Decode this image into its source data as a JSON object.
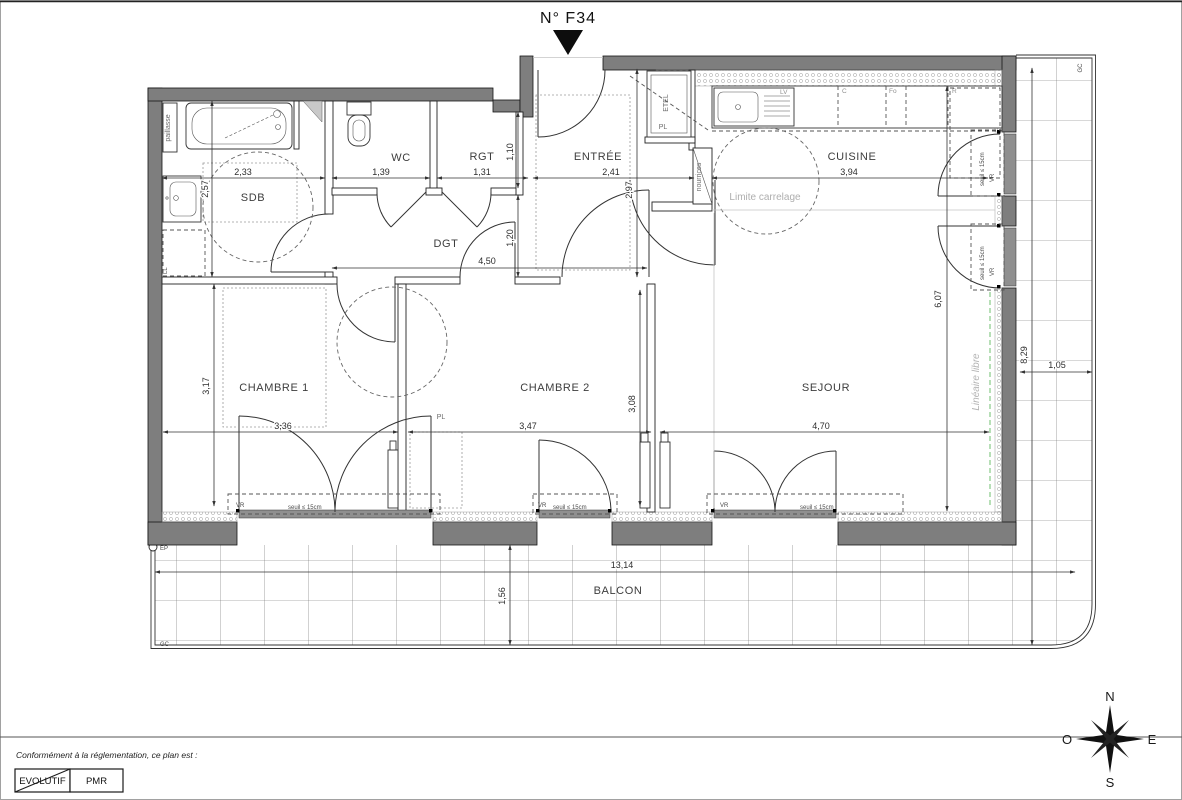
{
  "title": {
    "label": "N° F34"
  },
  "rooms": {
    "sdb": "SDB",
    "wc": "WC",
    "rgt": "RGT",
    "entree": "ENTRÉE",
    "cuisine": "CUISINE",
    "dgt": "DGT",
    "chambre1": "CHAMBRE 1",
    "chambre2": "CHAMBRE 2",
    "sejour": "SEJOUR",
    "balcon": "BALCON"
  },
  "dims": {
    "sdb_w": "2,33",
    "sdb_h": "2,57",
    "wc_w": "1,39",
    "rgt_w": "1,31",
    "rgt_h": "1,10",
    "entree_w": "2,41",
    "entree_h": "2,97",
    "cuisine_w": "3,94",
    "dgt_w": "4,50",
    "dgt_h": "1,20",
    "ch1_w": "3,36",
    "ch1_h": "3,17",
    "ch2_w": "3,47",
    "ch2_h": "3,08",
    "sejour_w": "4,70",
    "sejour_h": "6,07",
    "balcon_w": "13,14",
    "balcon_d": "1,56",
    "balcon_side_h": "8,29",
    "balcon_side_w": "1,05"
  },
  "annotations": {
    "paillasse": "paillasse",
    "ll": "LL",
    "etel": "ETEL",
    "pl": "PL",
    "nourrices": "nourrices",
    "limite": "Limite carrelage",
    "lineaire": "Linéaire libre",
    "vr": "VR",
    "seuil": "seuil ≤ 15cm",
    "gc": "GC",
    "ep": "EP"
  },
  "kitchen": {
    "lv": "LV",
    "c": "C",
    "fo": "Fo",
    "r": "R"
  },
  "compass": {
    "n": "N",
    "s": "S",
    "e": "E",
    "o": "O"
  },
  "legend": {
    "intro": "Conformément à la réglementation, ce plan est :",
    "evolutif": "EVOLUTIF",
    "pmr": "PMR"
  },
  "colors": {
    "wall": "#7e7e7e",
    "line": "#1c1c1c",
    "muted_text": "#aeaeae",
    "green_line": "#6fbf6f",
    "paper": "#ffffff"
  }
}
